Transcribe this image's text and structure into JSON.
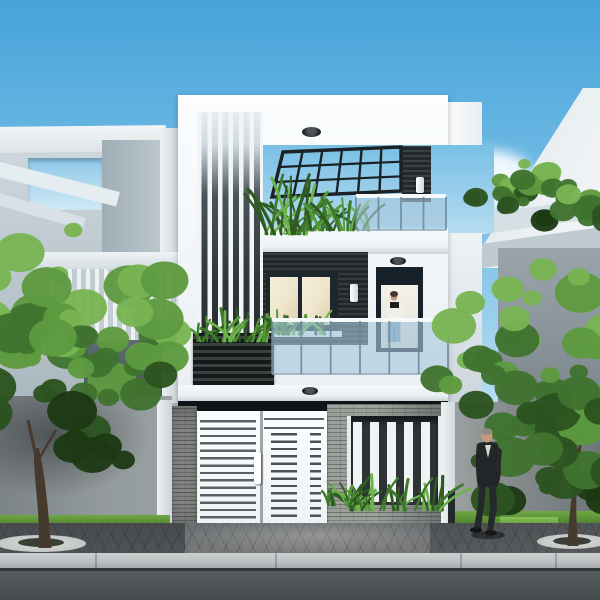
{
  "scene": {
    "description": "Photorealistic 3D exterior render of a modern 3-storey white townhouse with dark stone accents: rooftop terrace with dark pergola grid and plants, white vertical louvers, glass balconies (a person in a white shirt and jeans stands on the 1st-floor balcony), white horizontal-slat entry gate in a grey stone fence, neighbouring modern houses left and right, two green street trees, and a man in a dark suit walking on the paved sidewalk."
  },
  "palette": {
    "sky-top": "#46a3da",
    "sky-mid": "#7fc2e7",
    "sky-low": "#cfe9f5",
    "cloud": "#ffffff",
    "house-white": "#f7f9fa",
    "slab": "#eef3f5",
    "dark-panel": "#262c30",
    "frame-dark": "#1d272e",
    "glass-warm": "#f2ead6",
    "glass-blue": "#a6c7db",
    "rail-white": "#f6f9fa",
    "post-blue": "#6c8799",
    "stone": "#9b9f9a",
    "gate-white": "#fbfdfe",
    "gate-gap": "#5a6064",
    "recess": "#0e1315",
    "grass": "#6fa844",
    "pave": "#6e7173",
    "curb": "#c6c9ca",
    "road": "#50565 8",
    "trunk": "#463a2e",
    "tree-deep": "#1d3914",
    "tree-dark": "#2c5320",
    "tree-mid": "#40732f",
    "tree-light": "#5e9a40",
    "tree-hi": "#78b452",
    "leaf-1": "#2f5a22",
    "leaf-2": "#3f7a2c",
    "leaf-3": "#55983a",
    "leaf-4": "#6cb34b",
    "suit": "#26292b",
    "skin": "#c49a7e",
    "hair-gray": "#8d8d86",
    "jeans": "#7fa2c2",
    "shirt": "#f0efe9"
  },
  "pergola": {
    "x1": 283,
    "y1": 152,
    "x2": 401,
    "y2": 147,
    "x3": 401,
    "y3": 191,
    "x4": 272,
    "y4": 197,
    "cols": 7,
    "rows": 4
  },
  "rails": {
    "r3f": {
      "x": 356,
      "y": 194,
      "w": 90,
      "h": 36,
      "posts": 5
    },
    "r2f": {
      "x": 272,
      "y": 318,
      "w": 176,
      "h": 56,
      "posts": 7
    }
  },
  "plants": [
    {
      "cx": 285,
      "baseY": 234,
      "spread": 46,
      "hMin": 28,
      "hMax": 62,
      "n": 26,
      "seed": 11
    },
    {
      "cx": 338,
      "baseY": 230,
      "spread": 64,
      "hMin": 16,
      "hMax": 34,
      "n": 30,
      "seed": 21
    },
    {
      "cx": 233,
      "baseY": 341,
      "spread": 74,
      "hMin": 14,
      "hMax": 34,
      "n": 30,
      "seed": 31
    },
    {
      "cx": 300,
      "baseY": 334,
      "spread": 56,
      "hMin": 12,
      "hMax": 26,
      "n": 22,
      "seed": 41
    },
    {
      "cx": 398,
      "baseY": 510,
      "spread": 100,
      "hMin": 18,
      "hMax": 40,
      "n": 34,
      "seed": 51
    },
    {
      "cx": 338,
      "baseY": 505,
      "spread": 26,
      "hMin": 12,
      "hMax": 24,
      "n": 10,
      "seed": 61
    }
  ],
  "trees": [
    {
      "name": "left-tree",
      "cx": 78,
      "cy": 350,
      "rx": 112,
      "ry": 128,
      "n": 60,
      "seed": 7
    },
    {
      "name": "right-tree",
      "cx": 544,
      "cy": 398,
      "rx": 108,
      "ry": 138,
      "n": 60,
      "seed": 13
    },
    {
      "name": "top-right-tree",
      "cx": 528,
      "cy": 192,
      "rx": 58,
      "ry": 34,
      "n": 24,
      "seed": 3
    },
    {
      "name": "top-right-tree-2",
      "cx": 589,
      "cy": 208,
      "rx": 33,
      "ry": 24,
      "n": 14,
      "seed": 5
    }
  ],
  "trunks": [
    {
      "name": "left-trunk",
      "bx": 44,
      "base": 548,
      "top": 448,
      "lean": -8,
      "w": 11
    },
    {
      "name": "right-trunk",
      "bx": 572,
      "base": 546,
      "top": 450,
      "lean": 6,
      "w": 9
    }
  ],
  "people": {
    "balcony_person": {
      "x": 394,
      "headY": 294,
      "floorY": 350
    },
    "walking_man": {
      "x": 487,
      "headY": 436,
      "floorY": 533
    }
  },
  "curb_joints": [
    95,
    275,
    460,
    555
  ]
}
